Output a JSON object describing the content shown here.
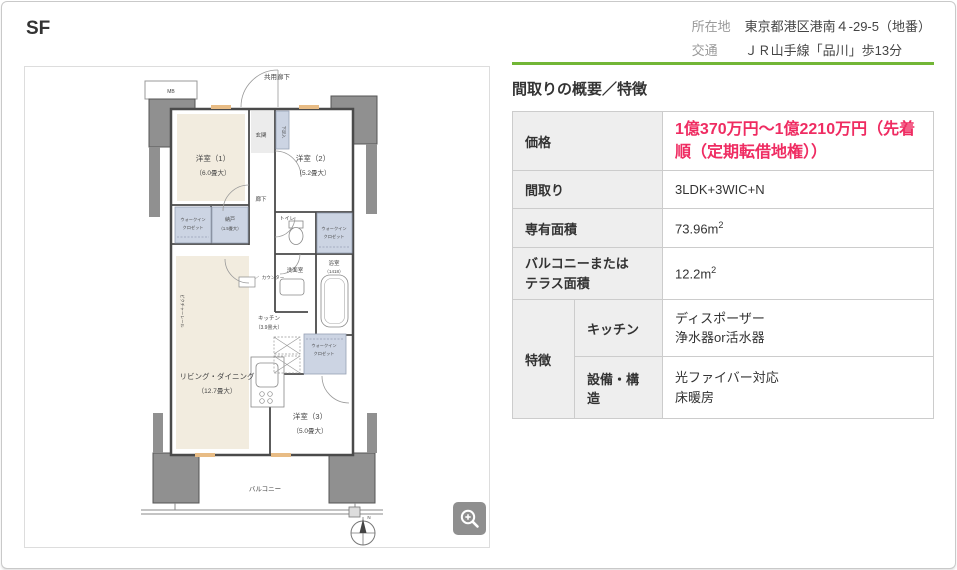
{
  "page": {
    "title": "SF"
  },
  "header": {
    "location_label": "所在地",
    "location_value": "東京都港区港南４-29-5（地番）",
    "access_label": "交通",
    "access_value": "ＪＲ山手線「品川」歩13分"
  },
  "overview": {
    "heading": "間取りの概要／特徴",
    "rows": {
      "price": {
        "label": "価格",
        "value": "1億370万円～1億2210万円（先着順（定期転借地権））"
      },
      "layout": {
        "label": "間取り",
        "value": "3LDK+3WIC+N"
      },
      "area": {
        "label": "専有面積",
        "value": "73.96m",
        "sup": "2"
      },
      "balcony": {
        "label_lines": [
          "バルコニーまたは",
          "テラス面積"
        ],
        "value": "12.2m",
        "sup": "2"
      },
      "features": {
        "label": "特徴",
        "kitchen": {
          "label": "キッチン",
          "lines": [
            "ディスポーザー",
            "浄水器or活水器"
          ]
        },
        "equipment": {
          "label": "設備・構造",
          "lines": [
            "光ファイバー対応",
            "床暖房"
          ]
        }
      }
    }
  },
  "floorplan": {
    "corridor": "共用廊下",
    "mb": "MB",
    "room1_name": "洋室（1）",
    "room1_size": "（6.0畳大）",
    "entrance": "玄関",
    "shoebox": "下足入",
    "room2_name": "洋室（2）",
    "room2_size": "（5.2畳大）",
    "hall": "廊下",
    "toilet": "トイレ",
    "wic_line1": "ウォークイン",
    "wic_line2": "クロゼット",
    "storage_name": "納戸",
    "storage_size": "（1.5畳大）",
    "washroom": "洗面室",
    "bath_name": "浴室",
    "bath_size": "（1418）",
    "kitchen_name": "キッチン",
    "kitchen_size": "（3.9畳大）",
    "counter": "カウンター",
    "ld_name": "リビング・ダイニング",
    "ld_size": "（12.7畳大）",
    "room3_name": "洋室（3）",
    "room3_size": "（5.0畳大）",
    "balcony": "バルコニー",
    "picture_rail": "ピクチャーレール",
    "north": "N"
  },
  "colors": {
    "accent_green": "#72b636",
    "price_pink": "#ef2c62",
    "label_cell_bg": "#eeeeee",
    "table_border": "#cccccc",
    "tatami_cream": "#f2ecdf",
    "closet_blue": "#ccd4e3",
    "pillar_gray": "#909090"
  }
}
